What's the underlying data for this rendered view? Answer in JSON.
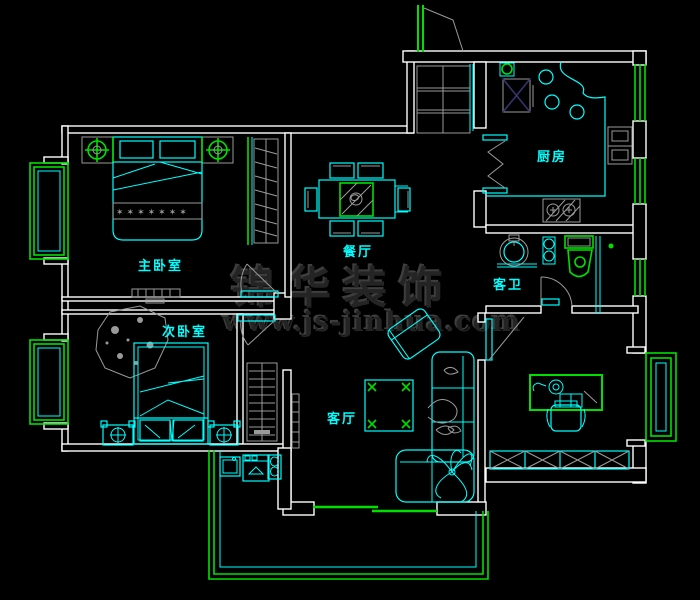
{
  "plan": {
    "rooms": [
      {
        "id": "master-bedroom",
        "label": "主卧室"
      },
      {
        "id": "second-bedroom",
        "label": "次卧室"
      },
      {
        "id": "dining-room",
        "label": "餐厅"
      },
      {
        "id": "kitchen",
        "label": "厨房"
      },
      {
        "id": "guest-bathroom",
        "label": "客卫"
      },
      {
        "id": "living-room",
        "label": "客厅"
      }
    ],
    "star_band": "✶✶✶✶✶✶✶"
  },
  "watermark": {
    "brand": "锦华装饰",
    "website": "www.js-jinhua.com"
  },
  "colors": {
    "background": "#000000",
    "wall": "#ffffff",
    "furniture": "#00ffff",
    "window": "#00e000",
    "detail": "#9a9a9a",
    "label": "#00ffff",
    "appliance": "#35356e",
    "watermark": "#242424",
    "watermark_hi": "#3e3e3e"
  }
}
